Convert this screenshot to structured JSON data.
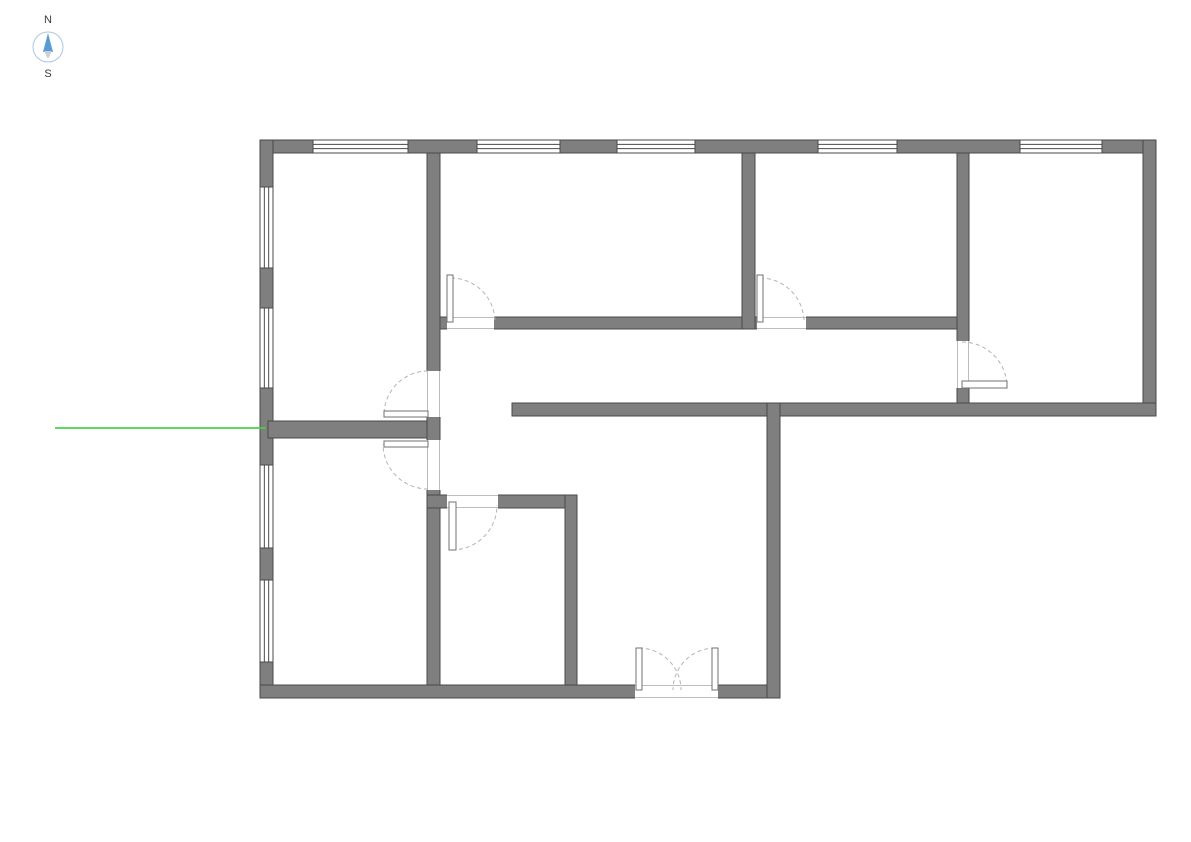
{
  "canvas": {
    "width": 1191,
    "height": 842,
    "background": "#ffffff"
  },
  "compass": {
    "north_label": "N",
    "south_label": "S",
    "cx": 48,
    "cy": 47,
    "r": 15,
    "ring_color": "#aac7e4",
    "north_color": "#5b9bd5",
    "south_color": "#c9cfd4",
    "label_color": "#3a3a3a"
  },
  "plan": {
    "wall_fill": "#7f7f7f",
    "wall_stroke": "#4a4a4a",
    "window_fill": "#ffffff",
    "window_line_color": "#4a4a4a",
    "door_leaf_fill": "#ffffff",
    "door_leaf_stroke": "#707070",
    "door_arc_color": "#b3b3b3",
    "jamb_line_color": "#bdbdbd",
    "walls": [
      {
        "name": "exterior-top",
        "x": 260,
        "y": 140,
        "w": 896,
        "h": 13
      },
      {
        "name": "exterior-left",
        "x": 260,
        "y": 140,
        "w": 13,
        "h": 558
      },
      {
        "name": "exterior-right",
        "x": 1143,
        "y": 140,
        "w": 13,
        "h": 276
      },
      {
        "name": "exterior-bottom",
        "x": 260,
        "y": 685,
        "w": 520,
        "h": 13
      },
      {
        "name": "south-band",
        "x": 512,
        "y": 403,
        "w": 644,
        "h": 13
      },
      {
        "name": "east-wing",
        "x": 767,
        "y": 403,
        "w": 13,
        "h": 295
      },
      {
        "name": "interior-v1",
        "x": 427,
        "y": 153,
        "w": 13,
        "h": 532
      },
      {
        "name": "divider-left-rooms",
        "x": 268,
        "y": 421,
        "w": 159,
        "h": 17
      },
      {
        "name": "corridor-north",
        "x": 440,
        "y": 317,
        "w": 517,
        "h": 12
      },
      {
        "name": "interior-v2",
        "x": 742,
        "y": 153,
        "w": 13,
        "h": 176
      },
      {
        "name": "interior-v3",
        "x": 957,
        "y": 153,
        "w": 12,
        "h": 250
      },
      {
        "name": "smallroom-top",
        "x": 427,
        "y": 495,
        "w": 150,
        "h": 13
      },
      {
        "name": "smallroom-right",
        "x": 565,
        "y": 495,
        "w": 12,
        "h": 190
      }
    ],
    "openings": [
      {
        "x": 447,
        "y": 316,
        "w": 47,
        "h": 14,
        "orient": "h"
      },
      {
        "x": 757,
        "y": 316,
        "w": 49,
        "h": 14,
        "orient": "h"
      },
      {
        "x": 956,
        "y": 341,
        "w": 14,
        "h": 47,
        "orient": "v"
      },
      {
        "x": 426,
        "y": 371,
        "w": 15,
        "h": 46,
        "orient": "v"
      },
      {
        "x": 426,
        "y": 440,
        "w": 15,
        "h": 50,
        "orient": "v"
      },
      {
        "x": 447,
        "y": 494,
        "w": 51,
        "h": 15,
        "orient": "h"
      },
      {
        "x": 635,
        "y": 684,
        "w": 83,
        "h": 15,
        "orient": "h"
      }
    ],
    "windows": [
      {
        "x": 313,
        "y": 140,
        "w": 95,
        "h": 13,
        "orient": "h"
      },
      {
        "x": 477,
        "y": 140,
        "w": 83,
        "h": 13,
        "orient": "h"
      },
      {
        "x": 617,
        "y": 140,
        "w": 78,
        "h": 13,
        "orient": "h"
      },
      {
        "x": 818,
        "y": 140,
        "w": 79,
        "h": 13,
        "orient": "h"
      },
      {
        "x": 1020,
        "y": 140,
        "w": 82,
        "h": 13,
        "orient": "h"
      },
      {
        "x": 260,
        "y": 187,
        "w": 13,
        "h": 81,
        "orient": "v"
      },
      {
        "x": 260,
        "y": 308,
        "w": 13,
        "h": 80,
        "orient": "v"
      },
      {
        "x": 260,
        "y": 465,
        "w": 13,
        "h": 83,
        "orient": "v"
      },
      {
        "x": 260,
        "y": 580,
        "w": 13,
        "h": 82,
        "orient": "v"
      }
    ],
    "doors": [
      {
        "name": "door-top-middle-room",
        "leaf": {
          "x": 447,
          "y": 275,
          "w": 6,
          "h": 47
        },
        "arc": "M 451 278 A 44 44 0 0 1 495 322"
      },
      {
        "name": "door-top-right-room",
        "leaf": {
          "x": 757,
          "y": 275,
          "w": 6,
          "h": 47
        },
        "arc": "M 760 278 A 44 44 0 0 1 804 322"
      },
      {
        "name": "door-east-room",
        "leaf": {
          "x": 962,
          "y": 381,
          "w": 45,
          "h": 7
        },
        "arc": "M 962 342 A 45 45 0 0 1 1007 387"
      },
      {
        "name": "door-top-left-room",
        "leaf": {
          "x": 384,
          "y": 411,
          "w": 44,
          "h": 6
        },
        "arc": "M 428 371 A 44 44 0 0 0 384 415"
      },
      {
        "name": "door-bottom-left-room",
        "leaf": {
          "x": 384,
          "y": 441,
          "w": 44,
          "h": 6
        },
        "arc": "M 428 489 A 45 45 0 0 1 383 444"
      },
      {
        "name": "door-small-room",
        "leaf": {
          "x": 449,
          "y": 502,
          "w": 7,
          "h": 48
        },
        "arc": "M 452 550 A 45 45 0 0 0 497 505"
      },
      {
        "name": "double-door-left",
        "leaf": {
          "x": 636,
          "y": 648,
          "w": 6,
          "h": 42
        },
        "arc": "M 639 648 A 42 42 0 0 1 681 690"
      },
      {
        "name": "double-door-right",
        "leaf": {
          "x": 712,
          "y": 648,
          "w": 6,
          "h": 42
        },
        "arc": "M 715 648 A 42 42 0 0 0 673 690"
      }
    ],
    "guide_line": {
      "x1": 55,
      "y1": 428,
      "x2": 266,
      "y2": 428,
      "color": "#46d046",
      "width": 2
    }
  }
}
